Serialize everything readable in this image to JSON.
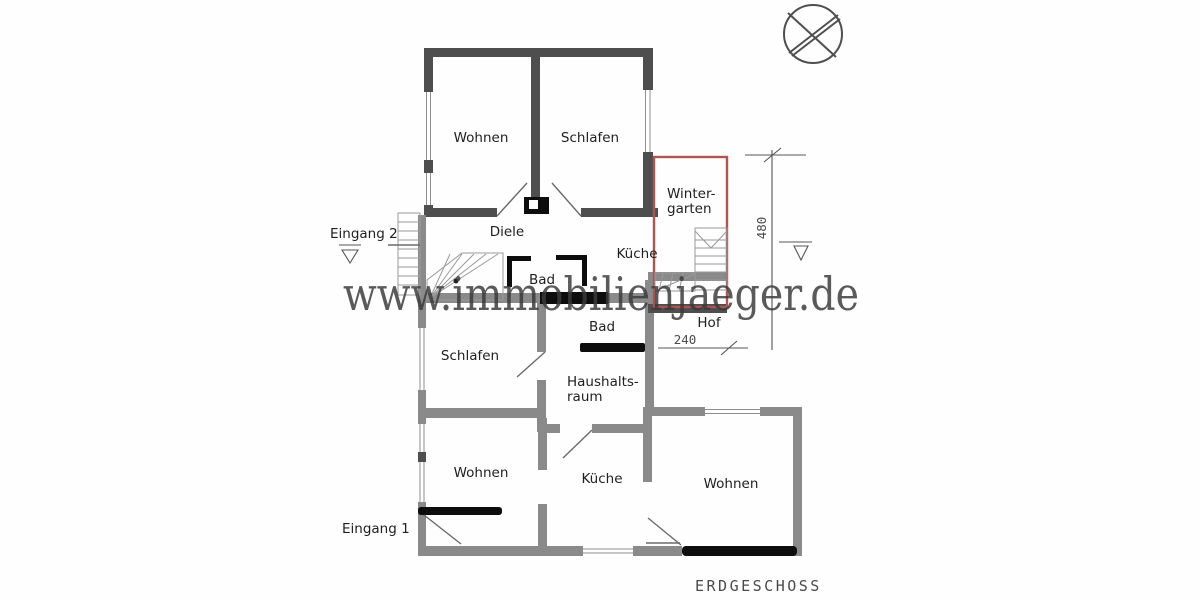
{
  "plan": {
    "title": "ERDGESCHOSS",
    "watermark": "www.immobilienjaeger.de",
    "rooms": {
      "wohnen_top": "Wohnen",
      "schlafen_top": "Schlafen",
      "wintergarten_line1": "Winter-",
      "wintergarten_line2": "garten",
      "diele": "Diele",
      "kueche_upper": "Küche",
      "bad_upper": "Bad",
      "bad_lower": "Bad",
      "hof": "Hof",
      "schlafen_lower": "Schlafen",
      "haushaltsraum_line1": "Haushalts-",
      "haushaltsraum_line2": "raum",
      "wohnen_bottom_left": "Wohnen",
      "kueche_lower": "Küche",
      "wohnen_bottom_right": "Wohnen"
    },
    "entrances": {
      "eingang_1": "Eingang 1",
      "eingang_2": "Eingang 2"
    },
    "dimensions": {
      "height_cm": "480",
      "width_cm": "240"
    },
    "colors": {
      "wall_dark": "#4e4e4e",
      "wall_gray": "#8a8a8a",
      "door_black": "#0d0d0d",
      "wintergarten_red": "#b15450",
      "watermark_gray": "#3a3a3a",
      "label_black": "#1f1f1f",
      "dim_gray": "#555555"
    }
  }
}
